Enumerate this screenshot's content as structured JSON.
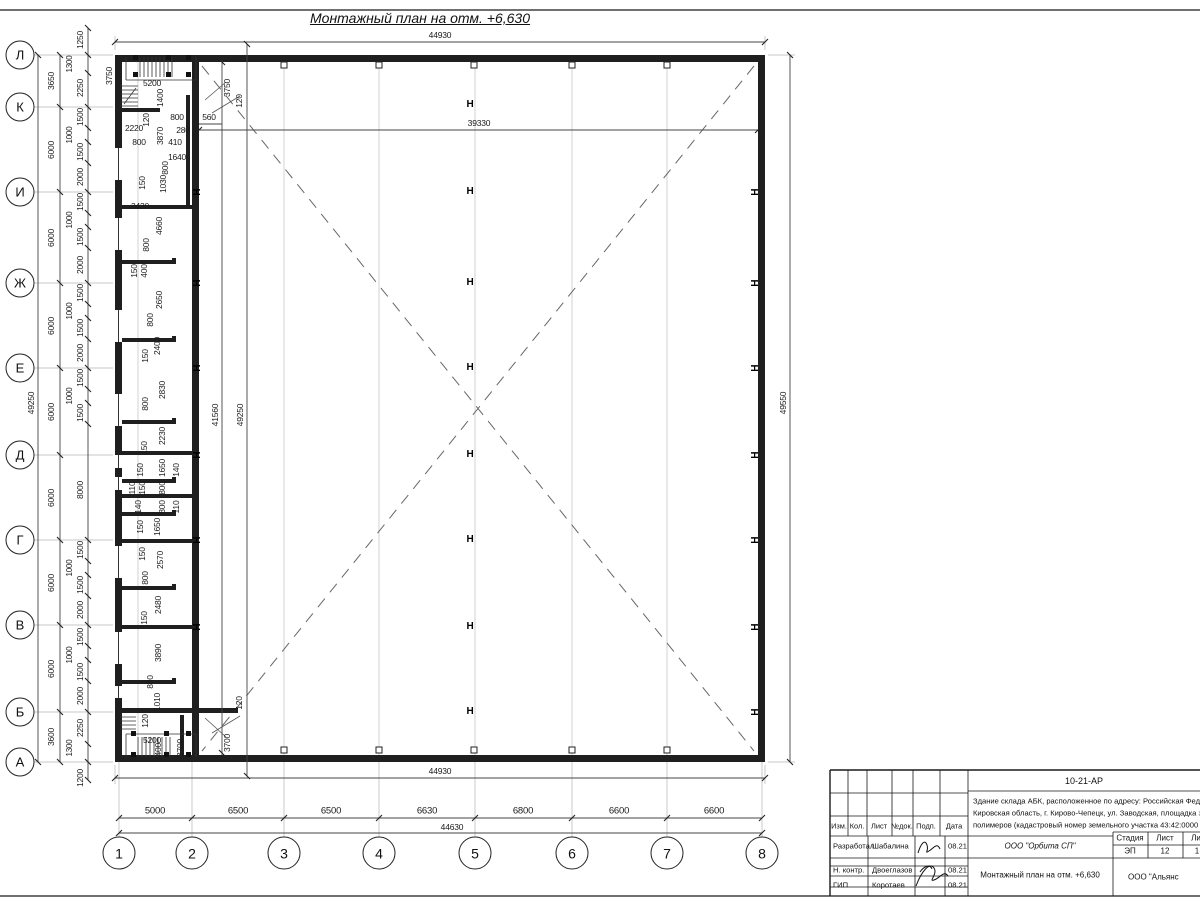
{
  "title": "Монтажный план на отм. +6,630",
  "colors": {
    "line": "#1a1a1a",
    "dim": "#444",
    "grid": "#c9c9c9",
    "diagonal": "#666"
  },
  "dims": {
    "top_overall": "44930",
    "hall_width": "39330",
    "bottom_building": "44930",
    "bottom_overall": "44630",
    "right_overall": "49550",
    "left_overall": "49250"
  },
  "axes": {
    "rows": [
      {
        "label": "Л",
        "y": 55
      },
      {
        "label": "К",
        "y": 107
      },
      {
        "label": "И",
        "y": 192
      },
      {
        "label": "Ж",
        "y": 283
      },
      {
        "label": "Е",
        "y": 368
      },
      {
        "label": "Д",
        "y": 455
      },
      {
        "label": "Г",
        "y": 540
      },
      {
        "label": "В",
        "y": 625
      },
      {
        "label": "Б",
        "y": 712
      },
      {
        "label": "А",
        "y": 762
      }
    ],
    "cols": [
      {
        "label": "1",
        "x": 119
      },
      {
        "label": "2",
        "x": 192
      },
      {
        "label": "3",
        "x": 284
      },
      {
        "label": "4",
        "x": 379
      },
      {
        "label": "5",
        "x": 475
      },
      {
        "label": "6",
        "x": 572
      },
      {
        "label": "7",
        "x": 667
      },
      {
        "label": "8",
        "x": 762
      }
    ]
  },
  "left_major": [
    {
      "t": "3650",
      "y": 81
    },
    {
      "t": "6000",
      "y": 150
    },
    {
      "t": "6000",
      "y": 238
    },
    {
      "t": "6000",
      "y": 326
    },
    {
      "t": "6000",
      "y": 412
    },
    {
      "t": "6000",
      "y": 498
    },
    {
      "t": "6000",
      "y": 583
    },
    {
      "t": "6000",
      "y": 669
    },
    {
      "t": "3600",
      "y": 737
    }
  ],
  "left_minor": [
    {
      "t": "1250",
      "y": 40
    },
    {
      "t": "1300",
      "y": 64,
      "off": 1
    },
    {
      "t": "2250",
      "y": 88
    },
    {
      "t": "1500",
      "y": 117
    },
    {
      "t": "1000",
      "y": 135,
      "off": 1
    },
    {
      "t": "1500",
      "y": 152
    },
    {
      "t": "2000",
      "y": 177
    },
    {
      "t": "1500",
      "y": 202
    },
    {
      "t": "1000",
      "y": 220,
      "off": 1
    },
    {
      "t": "1500",
      "y": 237
    },
    {
      "t": "2000",
      "y": 265
    },
    {
      "t": "1500",
      "y": 293
    },
    {
      "t": "1000",
      "y": 311,
      "off": 1
    },
    {
      "t": "1500",
      "y": 328
    },
    {
      "t": "2000",
      "y": 353
    },
    {
      "t": "1500",
      "y": 378
    },
    {
      "t": "1000",
      "y": 396,
      "off": 1
    },
    {
      "t": "1500",
      "y": 413
    },
    {
      "t": "8000",
      "y": 490
    },
    {
      "t": "1500",
      "y": 550
    },
    {
      "t": "1000",
      "y": 568,
      "off": 1
    },
    {
      "t": "1500",
      "y": 585
    },
    {
      "t": "2000",
      "y": 610
    },
    {
      "t": "1500",
      "y": 637
    },
    {
      "t": "1000",
      "y": 655,
      "off": 1
    },
    {
      "t": "1500",
      "y": 672
    },
    {
      "t": "2000",
      "y": 696
    },
    {
      "t": "2250",
      "y": 728
    },
    {
      "t": "1300",
      "y": 748,
      "off": 1
    },
    {
      "t": "1200",
      "y": 778
    }
  ],
  "bottom_segments": [
    {
      "t": "5000",
      "x": 155
    },
    {
      "t": "6500",
      "x": 238
    },
    {
      "t": "6500",
      "x": 331
    },
    {
      "t": "6630",
      "x": 427
    },
    {
      "t": "6800",
      "x": 523
    },
    {
      "t": "6600",
      "x": 619
    },
    {
      "t": "6600",
      "x": 714
    }
  ],
  "vertical_overall": [
    {
      "t": "41560",
      "x": 215,
      "y": 415,
      "v": 1
    },
    {
      "t": "49250",
      "x": 240,
      "y": 415,
      "v": 1
    },
    {
      "t": "49550",
      "x": 783,
      "y": 403,
      "v": 1
    },
    {
      "t": "49250",
      "x": 31,
      "y": 403,
      "v": 1
    }
  ],
  "plan_labels": [
    {
      "t": "3750",
      "x": 109,
      "y": 76,
      "v": 1
    },
    {
      "t": "5200",
      "x": 152,
      "y": 83
    },
    {
      "t": "1400",
      "x": 160,
      "y": 98,
      "v": 1
    },
    {
      "t": "120",
      "x": 146,
      "y": 120,
      "v": 1
    },
    {
      "t": "800",
      "x": 177,
      "y": 117
    },
    {
      "t": "280",
      "x": 183,
      "y": 130
    },
    {
      "t": "560",
      "x": 209,
      "y": 117
    },
    {
      "t": "3750",
      "x": 227,
      "y": 88,
      "v": 1
    },
    {
      "t": "120",
      "x": 239,
      "y": 101,
      "v": 1
    },
    {
      "t": "2220",
      "x": 134,
      "y": 128
    },
    {
      "t": "800",
      "x": 139,
      "y": 142
    },
    {
      "t": "3870",
      "x": 160,
      "y": 136,
      "v": 1
    },
    {
      "t": "410",
      "x": 175,
      "y": 142
    },
    {
      "t": "1640",
      "x": 177,
      "y": 157
    },
    {
      "t": "800",
      "x": 165,
      "y": 168,
      "v": 1
    },
    {
      "t": "150",
      "x": 142,
      "y": 183,
      "v": 1
    },
    {
      "t": "1030",
      "x": 163,
      "y": 184,
      "v": 1
    },
    {
      "t": "3430",
      "x": 140,
      "y": 206
    },
    {
      "t": "4660",
      "x": 159,
      "y": 226,
      "v": 1
    },
    {
      "t": "800",
      "x": 146,
      "y": 245,
      "v": 1
    },
    {
      "t": "150",
      "x": 134,
      "y": 271,
      "v": 1
    },
    {
      "t": "400",
      "x": 144,
      "y": 271,
      "v": 1
    },
    {
      "t": "2650",
      "x": 159,
      "y": 300,
      "v": 1
    },
    {
      "t": "800",
      "x": 150,
      "y": 320,
      "v": 1
    },
    {
      "t": "2400",
      "x": 157,
      "y": 346,
      "v": 1
    },
    {
      "t": "150",
      "x": 145,
      "y": 356,
      "v": 1
    },
    {
      "t": "2830",
      "x": 162,
      "y": 390,
      "v": 1
    },
    {
      "t": "800",
      "x": 145,
      "y": 404,
      "v": 1
    },
    {
      "t": "2230",
      "x": 162,
      "y": 436,
      "v": 1
    },
    {
      "t": "150",
      "x": 144,
      "y": 448,
      "v": 1
    },
    {
      "t": "1650",
      "x": 162,
      "y": 468,
      "v": 1
    },
    {
      "t": "150",
      "x": 140,
      "y": 470,
      "v": 1
    },
    {
      "t": "140",
      "x": 176,
      "y": 470,
      "v": 1
    },
    {
      "t": "110",
      "x": 132,
      "y": 488,
      "v": 1
    },
    {
      "t": "150",
      "x": 142,
      "y": 488,
      "v": 1
    },
    {
      "t": "800",
      "x": 162,
      "y": 488,
      "v": 1
    },
    {
      "t": "140",
      "x": 138,
      "y": 507,
      "v": 1
    },
    {
      "t": "800",
      "x": 162,
      "y": 507,
      "v": 1
    },
    {
      "t": "110",
      "x": 176,
      "y": 507,
      "v": 1
    },
    {
      "t": "150",
      "x": 140,
      "y": 527,
      "v": 1
    },
    {
      "t": "1650",
      "x": 157,
      "y": 527,
      "v": 1
    },
    {
      "t": "150",
      "x": 142,
      "y": 554,
      "v": 1
    },
    {
      "t": "2570",
      "x": 160,
      "y": 560,
      "v": 1
    },
    {
      "t": "800",
      "x": 145,
      "y": 578,
      "v": 1
    },
    {
      "t": "2480",
      "x": 158,
      "y": 605,
      "v": 1
    },
    {
      "t": "150",
      "x": 144,
      "y": 618,
      "v": 1
    },
    {
      "t": "3890",
      "x": 158,
      "y": 653,
      "v": 1
    },
    {
      "t": "800",
      "x": 150,
      "y": 682,
      "v": 1
    },
    {
      "t": "1010",
      "x": 157,
      "y": 702,
      "v": 1
    },
    {
      "t": "120",
      "x": 145,
      "y": 721,
      "v": 1
    },
    {
      "t": "5200",
      "x": 152,
      "y": 740
    },
    {
      "t": "1400",
      "x": 158,
      "y": 752,
      "v": 1
    },
    {
      "t": "3700",
      "x": 180,
      "y": 748,
      "v": 1
    },
    {
      "t": "120",
      "x": 239,
      "y": 703,
      "v": 1
    },
    {
      "t": "3700",
      "x": 227,
      "y": 743,
      "v": 1
    }
  ],
  "column_marks": [
    {
      "t": "Н",
      "x": 470,
      "y": 105
    },
    {
      "t": "Н",
      "x": 470,
      "y": 192
    },
    {
      "t": "Н",
      "x": 470,
      "y": 283
    },
    {
      "t": "Н",
      "x": 470,
      "y": 368
    },
    {
      "t": "Н",
      "x": 470,
      "y": 455
    },
    {
      "t": "Н",
      "x": 470,
      "y": 540
    },
    {
      "t": "Н",
      "x": 470,
      "y": 627
    },
    {
      "t": "Н",
      "x": 470,
      "y": 712
    },
    {
      "t": "Н",
      "x": 195,
      "y": 192,
      "v": 1
    },
    {
      "t": "Н",
      "x": 195,
      "y": 283,
      "v": 1
    },
    {
      "t": "Н",
      "x": 195,
      "y": 368,
      "v": 1
    },
    {
      "t": "Н",
      "x": 195,
      "y": 455,
      "v": 1
    },
    {
      "t": "Н",
      "x": 195,
      "y": 540,
      "v": 1
    },
    {
      "t": "Н",
      "x": 195,
      "y": 627,
      "v": 1
    },
    {
      "t": "Н",
      "x": 753,
      "y": 192,
      "v": 1
    },
    {
      "t": "Н",
      "x": 753,
      "y": 283,
      "v": 1
    },
    {
      "t": "Н",
      "x": 753,
      "y": 368,
      "v": 1
    },
    {
      "t": "Н",
      "x": 753,
      "y": 455,
      "v": 1
    },
    {
      "t": "Н",
      "x": 753,
      "y": 540,
      "v": 1
    },
    {
      "t": "Н",
      "x": 753,
      "y": 627,
      "v": 1
    },
    {
      "t": "Н",
      "x": 753,
      "y": 712,
      "v": 1
    }
  ],
  "titleblock": {
    "doc_number": "10-21-АР",
    "description_lines": [
      {
        "t": "Здание склада АБК, расположенное по адресу: Российская Феде",
        "y": 801
      },
      {
        "t": "Кировская область, г. Кирово-Чепецк, ул. Заводская, площадка з",
        "y": 813
      },
      {
        "t": "полимеров (кадастровый номер земельного участка 43:42:0000",
        "y": 825
      }
    ],
    "rev_headers": [
      {
        "t": "Изм.",
        "x": 839
      },
      {
        "t": "Кол.",
        "x": 857
      },
      {
        "t": "Лист",
        "x": 879
      },
      {
        "t": "№док.",
        "x": 902,
        "off": 1
      },
      {
        "t": "Подп.",
        "x": 926
      },
      {
        "t": "Дата",
        "x": 954
      }
    ],
    "people": [
      {
        "role": "Разработал",
        "name": "Шабалина",
        "date": "08.21",
        "y": 846
      },
      {
        "role": "Н. контр.",
        "name": "Двоеглазов",
        "date": "08.21",
        "y": 870
      },
      {
        "role": "ГИП",
        "name": "Коротаев",
        "date": "08.21",
        "y": 885
      }
    ],
    "org": "ООО \"Орбита СП\"",
    "sheet_title": "Монтажный план на отм. +6,630",
    "stage_headers": [
      {
        "t": "Стадия",
        "x": 1130
      },
      {
        "t": "Лист",
        "x": 1165
      },
      {
        "t": "Ли",
        "x": 1196
      }
    ],
    "stage_values": [
      {
        "t": "ЭП",
        "x": 1130
      },
      {
        "t": "12",
        "x": 1165
      },
      {
        "t": "1",
        "x": 1197
      }
    ],
    "org2": "ООО \"Альянс"
  }
}
